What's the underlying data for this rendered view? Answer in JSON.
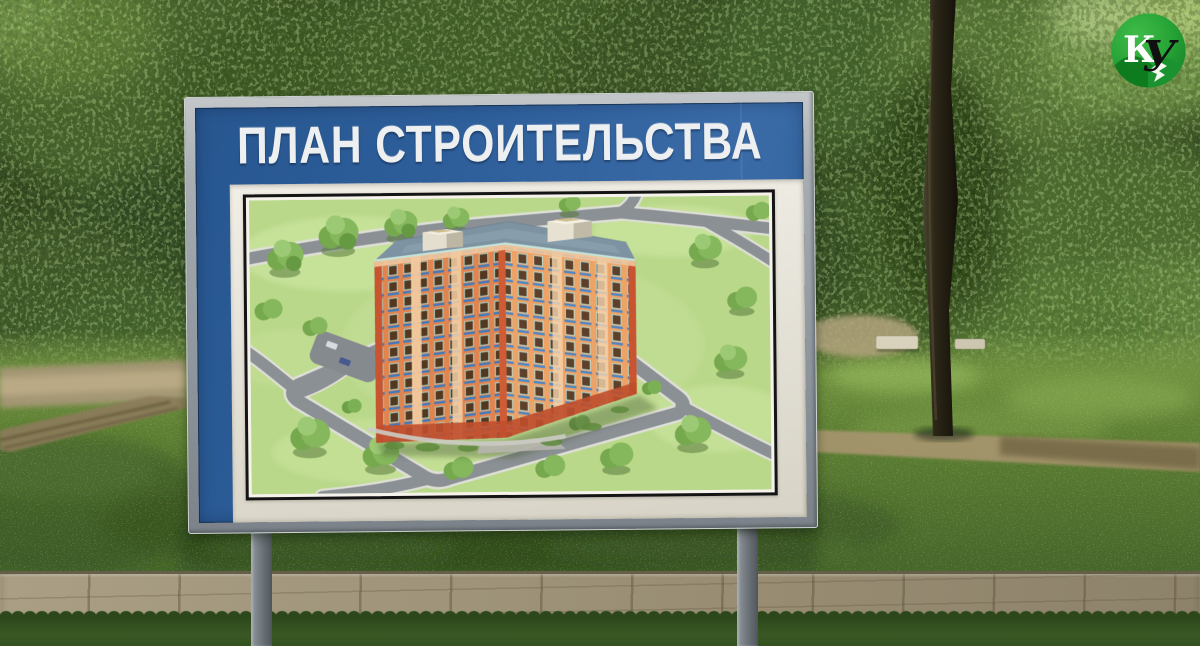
{
  "billboard": {
    "title": "ПЛАН СТРОИТЕЛЬСТВА"
  },
  "logo": {
    "letters": {
      "k": "К",
      "u": "У"
    }
  },
  "colors": {
    "billboard_blue": "#2e5f9b",
    "frame_gray": "#9aa0a5",
    "mat_cream": "#e7e4da",
    "logo_green": "#23a032",
    "plan_lawn_green": "#b9d889",
    "plan_road_gray": "#8b9095",
    "building_orange": "#e08550",
    "building_red_accent": "#c8552f",
    "building_roof_gray": "#7e93a2"
  }
}
